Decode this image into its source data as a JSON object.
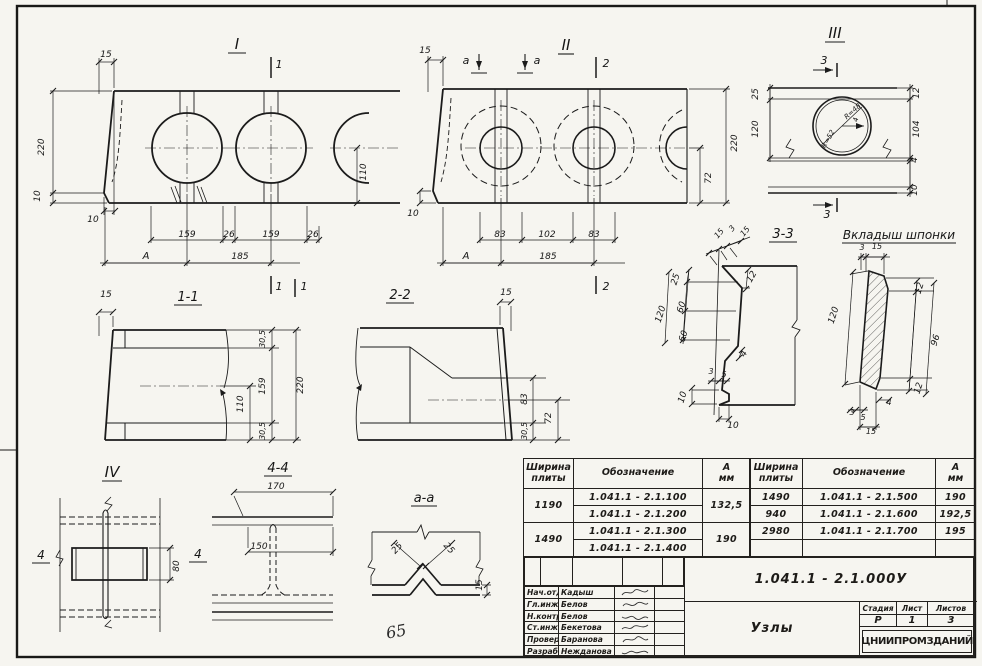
{
  "sheet": {
    "handwritten_mark": "65",
    "paper_color": "#f6f5f0",
    "line_color": "#1b1b1b"
  },
  "labels": [
    {
      "t": "I",
      "x": 237,
      "y": 49,
      "fs": 15,
      "u": 9,
      "n": "view-I-title"
    },
    {
      "t": "1",
      "x": 279,
      "y": 68,
      "fs": 11,
      "n": "cut-mark-label"
    },
    {
      "t": "1",
      "x": 279,
      "y": 290,
      "fs": 11,
      "n": "cut-mark-label"
    },
    {
      "t": "15",
      "x": 106,
      "y": 57,
      "fs": 9
    },
    {
      "t": "220",
      "x": 44,
      "y": 147,
      "fs": 9,
      "r": -90
    },
    {
      "t": "10",
      "x": 40,
      "y": 196,
      "fs": 9,
      "r": -90
    },
    {
      "t": "10",
      "x": 93,
      "y": 222,
      "fs": 9
    },
    {
      "t": "159",
      "x": 187,
      "y": 237,
      "fs": 9
    },
    {
      "t": "26",
      "x": 229,
      "y": 237,
      "fs": 9
    },
    {
      "t": "159",
      "x": 271,
      "y": 237,
      "fs": 9
    },
    {
      "t": "26",
      "x": 313,
      "y": 237,
      "fs": 9
    },
    {
      "t": "А",
      "x": 146,
      "y": 259,
      "fs": 10,
      "n": "axis-label"
    },
    {
      "t": "185",
      "x": 240,
      "y": 259,
      "fs": 9
    },
    {
      "t": "110",
      "x": 366,
      "y": 172,
      "fs": 9,
      "r": -90
    },
    {
      "t": "II",
      "x": 566,
      "y": 50,
      "fs": 15,
      "u": 8,
      "n": "view-II-title"
    },
    {
      "t": "a",
      "x": 466,
      "y": 64,
      "fs": 11,
      "n": "cut-mark-label"
    },
    {
      "t": "a",
      "x": 537,
      "y": 64,
      "fs": 11,
      "n": "cut-mark-label"
    },
    {
      "t": "2",
      "x": 606,
      "y": 67,
      "fs": 11,
      "n": "cut-mark-label"
    },
    {
      "t": "2",
      "x": 606,
      "y": 290,
      "fs": 11,
      "n": "cut-mark-label"
    },
    {
      "t": "15",
      "x": 425,
      "y": 53,
      "fs": 9
    },
    {
      "t": "10",
      "x": 413,
      "y": 216,
      "fs": 9
    },
    {
      "t": "83",
      "x": 500,
      "y": 237,
      "fs": 9
    },
    {
      "t": "102",
      "x": 547,
      "y": 237,
      "fs": 9
    },
    {
      "t": "83",
      "x": 594,
      "y": 237,
      "fs": 9
    },
    {
      "t": "А",
      "x": 466,
      "y": 259,
      "fs": 10,
      "n": "axis-label"
    },
    {
      "t": "185",
      "x": 548,
      "y": 259,
      "fs": 9
    },
    {
      "t": "72",
      "x": 711,
      "y": 178,
      "fs": 9,
      "r": -90
    },
    {
      "t": "220",
      "x": 737,
      "y": 143,
      "fs": 9,
      "r": -90
    },
    {
      "t": "III",
      "x": 835,
      "y": 38,
      "fs": 15,
      "u": 10,
      "n": "view-III-title"
    },
    {
      "t": "3",
      "x": 824,
      "y": 64,
      "fs": 11,
      "n": "cut-mark-label"
    },
    {
      "t": "3",
      "x": 827,
      "y": 218,
      "fs": 11,
      "n": "cut-mark-label"
    },
    {
      "t": "25",
      "x": 758,
      "y": 94,
      "fs": 9,
      "r": -90
    },
    {
      "t": "120",
      "x": 758,
      "y": 129,
      "fs": 9,
      "r": -90
    },
    {
      "t": "12",
      "x": 919,
      "y": 93,
      "fs": 9,
      "r": -90
    },
    {
      "t": "104",
      "x": 919,
      "y": 129,
      "fs": 9,
      "r": -90
    },
    {
      "t": "4",
      "x": 917,
      "y": 160,
      "fs": 9,
      "r": -90
    },
    {
      "t": "10",
      "x": 917,
      "y": 190,
      "fs": 9,
      "r": -90
    },
    {
      "t": "R=48",
      "x": 854,
      "y": 113,
      "fs": 7,
      "r": -42
    },
    {
      "t": "R=52",
      "x": 830,
      "y": 140,
      "fs": 7,
      "r": -60
    },
    {
      "t": "4",
      "x": 858,
      "y": 120,
      "fs": 7,
      "r": -80
    },
    {
      "t": "3-3",
      "x": 783,
      "y": 238,
      "fs": 13,
      "u": 14,
      "n": "section-3-3-title"
    },
    {
      "t": "15",
      "x": 721,
      "y": 235,
      "fs": 8,
      "r": -50
    },
    {
      "t": "3",
      "x": 734,
      "y": 230,
      "fs": 8,
      "r": -50
    },
    {
      "t": "15",
      "x": 747,
      "y": 233,
      "fs": 8,
      "r": -50
    },
    {
      "t": "25",
      "x": 678,
      "y": 280,
      "fs": 9,
      "r": -72
    },
    {
      "t": "60",
      "x": 684,
      "y": 308,
      "fs": 9,
      "r": -72
    },
    {
      "t": "120",
      "x": 663,
      "y": 315,
      "fs": 9,
      "r": -72
    },
    {
      "t": "60",
      "x": 686,
      "y": 337,
      "fs": 9,
      "r": -72
    },
    {
      "t": "12",
      "x": 754,
      "y": 278,
      "fs": 9,
      "r": -60
    },
    {
      "t": "4",
      "x": 746,
      "y": 355,
      "fs": 9,
      "r": -60
    },
    {
      "t": "3",
      "x": 711,
      "y": 374,
      "fs": 8
    },
    {
      "t": "5",
      "x": 724,
      "y": 377,
      "fs": 8
    },
    {
      "t": "10",
      "x": 685,
      "y": 398,
      "fs": 9,
      "r": -72
    },
    {
      "t": "10",
      "x": 733,
      "y": 428,
      "fs": 9
    },
    {
      "t": "Вкладыш шпонки",
      "x": 899,
      "y": 239,
      "fs": 12,
      "u": 57,
      "n": "insert-key-title"
    },
    {
      "t": "3",
      "x": 862,
      "y": 250,
      "fs": 8
    },
    {
      "t": "15",
      "x": 877,
      "y": 249,
      "fs": 8
    },
    {
      "t": "120",
      "x": 836,
      "y": 316,
      "fs": 9,
      "r": -72
    },
    {
      "t": "12",
      "x": 922,
      "y": 289,
      "fs": 9,
      "r": -72
    },
    {
      "t": "96",
      "x": 938,
      "y": 341,
      "fs": 9,
      "r": -72
    },
    {
      "t": "12",
      "x": 921,
      "y": 389,
      "fs": 9,
      "r": -72
    },
    {
      "t": "4",
      "x": 889,
      "y": 405,
      "fs": 8
    },
    {
      "t": "3",
      "x": 852,
      "y": 415,
      "fs": 8
    },
    {
      "t": "5",
      "x": 863,
      "y": 420,
      "fs": 8
    },
    {
      "t": "15",
      "x": 871,
      "y": 434,
      "fs": 8
    },
    {
      "t": "1-1",
      "x": 188,
      "y": 301,
      "fs": 13,
      "u": 14,
      "n": "section-1-1-title"
    },
    {
      "t": "1",
      "x": 304,
      "y": 290,
      "fs": 11,
      "n": "cut-mark-label"
    },
    {
      "t": "15",
      "x": 106,
      "y": 297,
      "fs": 9
    },
    {
      "t": "30,5",
      "x": 265,
      "y": 339,
      "fs": 8,
      "r": -90
    },
    {
      "t": "159",
      "x": 265,
      "y": 386,
      "fs": 9,
      "r": -90
    },
    {
      "t": "220",
      "x": 303,
      "y": 385,
      "fs": 9,
      "r": -90
    },
    {
      "t": "110",
      "x": 243,
      "y": 404,
      "fs": 9,
      "r": -90
    },
    {
      "t": "30,5",
      "x": 265,
      "y": 431,
      "fs": 8,
      "r": -90
    },
    {
      "t": "2-2",
      "x": 400,
      "y": 299,
      "fs": 13,
      "u": 14,
      "n": "section-2-2-title"
    },
    {
      "t": "15",
      "x": 506,
      "y": 295,
      "fs": 9
    },
    {
      "t": "83",
      "x": 527,
      "y": 399,
      "fs": 9,
      "r": -90
    },
    {
      "t": "72",
      "x": 551,
      "y": 418,
      "fs": 9,
      "r": -90
    },
    {
      "t": "30,5",
      "x": 527,
      "y": 431,
      "fs": 8,
      "r": -90
    },
    {
      "t": "IV",
      "x": 112,
      "y": 477,
      "fs": 15,
      "u": 10,
      "n": "view-IV-title"
    },
    {
      "t": "4",
      "x": 41,
      "y": 559,
      "fs": 12,
      "u": 9,
      "n": "cut-mark-label"
    },
    {
      "t": "4",
      "x": 198,
      "y": 558,
      "fs": 12,
      "u": 9,
      "n": "cut-mark-label"
    },
    {
      "t": "80",
      "x": 179,
      "y": 566,
      "fs": 9,
      "r": -90
    },
    {
      "t": "4-4",
      "x": 278,
      "y": 472,
      "fs": 13,
      "u": 14,
      "n": "section-4-4-title"
    },
    {
      "t": "170",
      "x": 276,
      "y": 489,
      "fs": 9
    },
    {
      "t": "150",
      "x": 259,
      "y": 549,
      "fs": 9
    },
    {
      "t": "а-а",
      "x": 424,
      "y": 502,
      "fs": 13,
      "u": 13,
      "n": "section-a-a-title"
    },
    {
      "t": "25",
      "x": 399,
      "y": 550,
      "fs": 9,
      "r": -47
    },
    {
      "t": "25",
      "x": 447,
      "y": 550,
      "fs": 9,
      "r": 47
    },
    {
      "t": "15",
      "x": 482,
      "y": 585,
      "fs": 9,
      "r": -90
    }
  ],
  "tables": {
    "headers": {
      "width": "Ширина\nплиты",
      "designation": "Обозначение",
      "a": "А\nмм"
    },
    "left": {
      "groups": [
        {
          "width": "1190",
          "a": "132,5",
          "designations": [
            "1.041.1 - 2.1.100",
            "1.041.1 - 2.1.200"
          ]
        },
        {
          "width": "1490",
          "a": "190",
          "designations": [
            "1.041.1 - 2.1.300",
            "1.041.1 - 2.1.400"
          ]
        }
      ]
    },
    "right": {
      "rows": [
        {
          "width": "1490",
          "designation": "1.041.1 - 2.1.500",
          "a": "190"
        },
        {
          "width": "940",
          "designation": "1.041.1 - 2.1.600",
          "a": "192,5"
        },
        {
          "width": "2980",
          "designation": "1.041.1 - 2.1.700",
          "a": "195"
        },
        {
          "width": "",
          "designation": "",
          "a": ""
        }
      ]
    }
  },
  "titleblock": {
    "doc_number": "1.041.1 - 2.1.000У",
    "drawing_title": "Узлы",
    "organization": "ЦНИИПРОМЗДАНИЙ",
    "stage_label": "Стадия",
    "sheet_label": "Лист",
    "sheets_label": "Листов",
    "stage": "Р",
    "sheet_no": "1",
    "sheet_count": "3",
    "personnel": [
      {
        "role": "Нач.отд.",
        "name": "Кадыш"
      },
      {
        "role": "Гл.инж.пр",
        "name": "Белов"
      },
      {
        "role": "Н.контр.",
        "name": "Белов"
      },
      {
        "role": "Ст.инж.",
        "name": "Бекетова"
      },
      {
        "role": "Провер.",
        "name": "Баранова"
      },
      {
        "role": "Разраб.",
        "name": "Нежданова"
      }
    ]
  }
}
